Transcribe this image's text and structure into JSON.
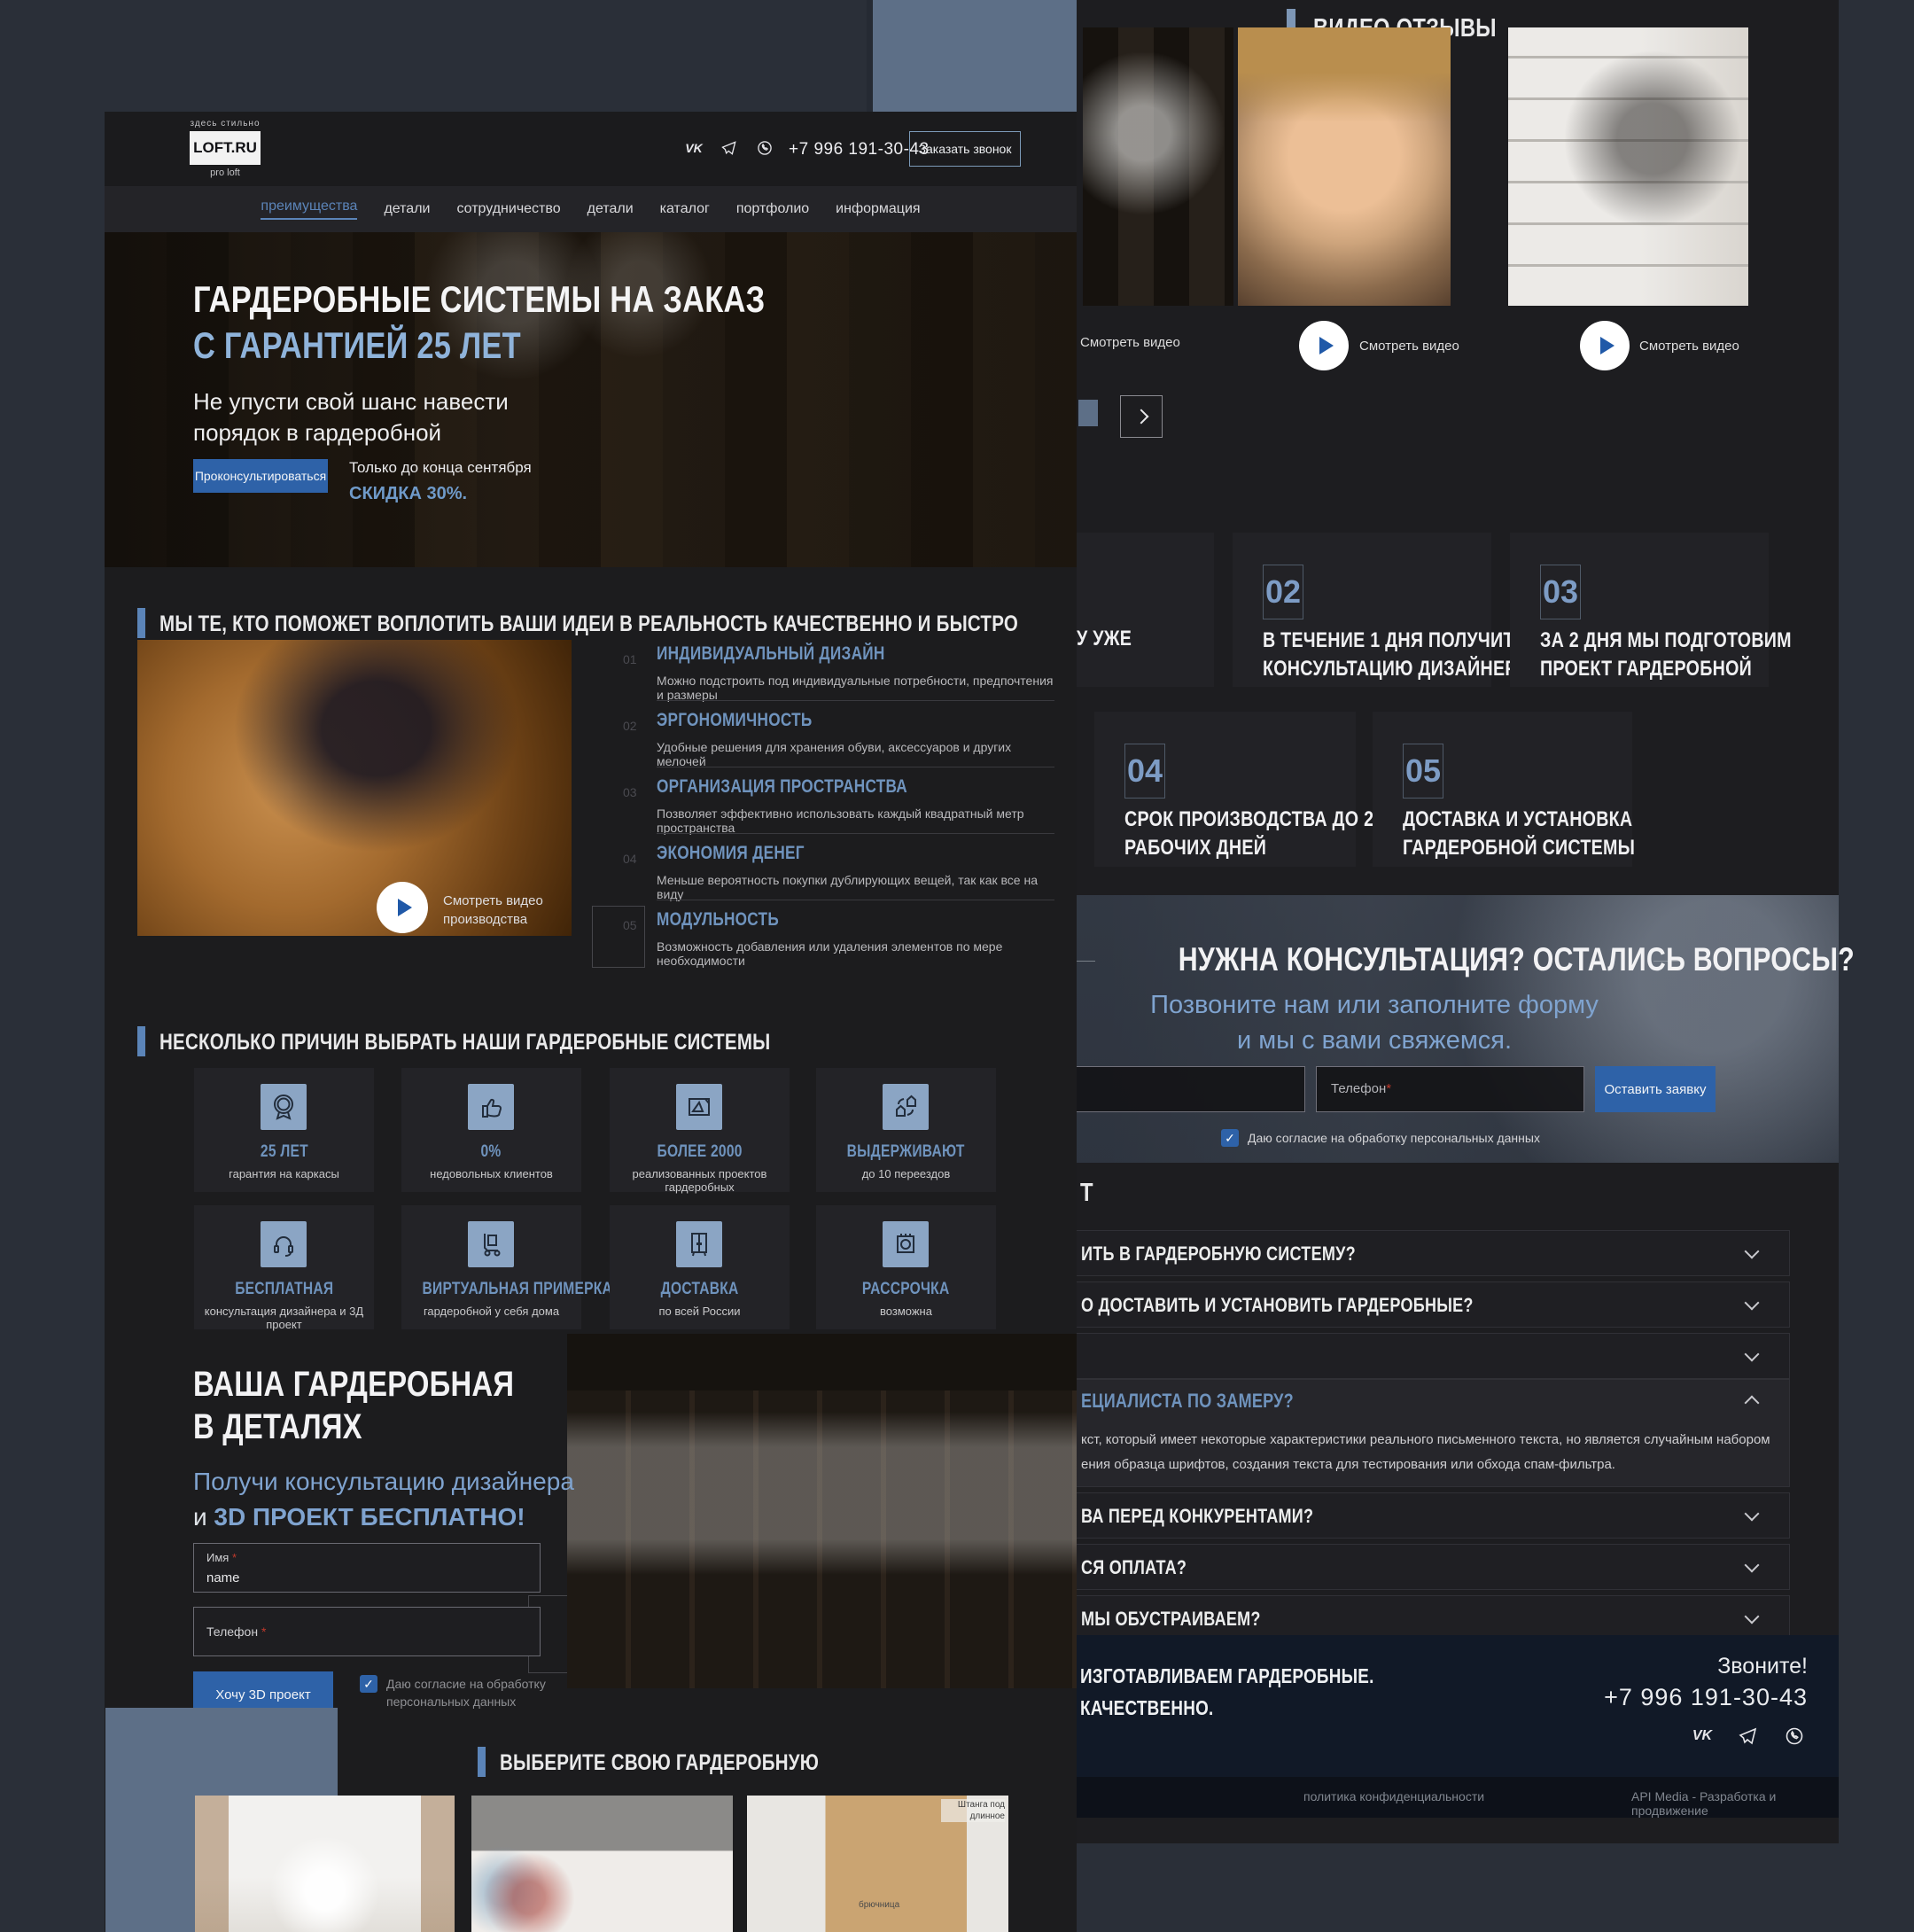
{
  "theme": {
    "canvas_bg": "#2a2f38",
    "page_bg": "#1c1c1e",
    "accent_button_blue": "#2e62a8",
    "heading_blue": "#6f93bd",
    "light_blue": "#8fb3da",
    "slate_decor": "#5d6f87",
    "footer_bg": "#111927"
  },
  "left_page": {
    "header": {
      "logo_top": "здесь стильно",
      "logo": "LOFT.RU",
      "logo_bottom": "pro loft",
      "socials": [
        "vk",
        "telegram",
        "whatsapp"
      ],
      "phone": "+7 996 191-30-43",
      "call_button": "Заказать звонок"
    },
    "nav": {
      "items": [
        {
          "label": "преимущества",
          "active": true
        },
        {
          "label": "детали"
        },
        {
          "label": "сотрудничество"
        },
        {
          "label": "детали"
        },
        {
          "label": "каталог"
        },
        {
          "label": "портфолио"
        },
        {
          "label": "информация"
        }
      ]
    },
    "hero": {
      "title_line1": "ГАРДЕРОБНЫЕ СИСТЕМЫ НА ЗАКАЗ",
      "title_line2": "С ГАРАНТИЕЙ 25 ЛЕТ",
      "subtitle_line1": "Не упусти свой шанс навести",
      "subtitle_line2": "порядок в гардеробной",
      "cta": "Проконсультироваться",
      "promo_line1": "Только до конца сентября",
      "promo_line2": "СКИДКА 30%."
    },
    "ideas": {
      "title": "МЫ ТЕ, КТО ПОМОЖЕТ ВОПЛОТИТЬ ВАШИ ИДЕИ В РЕАЛЬНОСТЬ КАЧЕСТВЕННО И БЫСТРО",
      "video_label": "Смотреть видео производства",
      "items": [
        {
          "num": "01",
          "title": "ИНДИВИДУАЛЬНЫЙ ДИЗАЙН",
          "text": "Можно подстроить под индивидуальные потребности, предпочтения и размеры"
        },
        {
          "num": "02",
          "title": "ЭРГОНОМИЧНОСТЬ",
          "text": "Удобные решения для хранения обуви, аксессуаров и других мелочей"
        },
        {
          "num": "03",
          "title": "ОРГАНИЗАЦИЯ ПРОСТРАНСТВА",
          "text": "Позволяет эффективно использовать каждый квадратный метр пространства"
        },
        {
          "num": "04",
          "title": "ЭКОНОМИЯ ДЕНЕГ",
          "text": "Меньше вероятность покупки дублирующих вещей, так как все на виду"
        },
        {
          "num": "05",
          "title": "МОДУЛЬНОСТЬ",
          "text": "Возможность добавления или удаления элементов по мере необходимости"
        }
      ]
    },
    "reasons": {
      "title": "НЕСКОЛЬКО ПРИЧИН ВЫБРАТЬ НАШИ ГАРДЕРОБНЫЕ СИСТЕМЫ",
      "cards": [
        {
          "icon": "guarantee-badge-icon",
          "title": "25 ЛЕТ",
          "text": "гарантия на каркасы"
        },
        {
          "icon": "thumb-up-icon",
          "title": "0%",
          "text": "недовольных клиентов"
        },
        {
          "icon": "blueprint-icon",
          "title": "БОЛЕЕ 2000",
          "text": "реализованных проектов гардеробных"
        },
        {
          "icon": "relocation-icon",
          "title": "ВЫДЕРЖИВАЮТ",
          "text": "до 10 переездов"
        },
        {
          "icon": "headset-icon",
          "title": "БЕСПЛАТНАЯ",
          "text": "консультация дизайнера и 3Д проект"
        },
        {
          "icon": "hand-truck-icon",
          "title": "ВИРТУАЛЬНАЯ ПРИМЕРКА",
          "text": "гардеробной у себя дома"
        },
        {
          "icon": "wardrobe-icon",
          "title": "ДОСТАВКА",
          "text": "по всей России"
        },
        {
          "icon": "installment-icon",
          "title": "РАССРОЧКА",
          "text": "возможна"
        }
      ]
    },
    "details": {
      "title_line1": "ВАША ГАРДЕРОБНАЯ",
      "title_line2": "В ДЕТАЛЯХ",
      "subtitle_line1": "Получи консультацию дизайнера",
      "subtitle_prefix": "и ",
      "subtitle_bold": "3D ПРОЕКТ БЕСПЛАТНО!",
      "form": {
        "name_label": "Имя",
        "name_value": "name",
        "phone_label": "Телефон",
        "required_mark": "*",
        "submit": "Хочу 3D проект",
        "consent_line1": "Даю  согласие на обработку",
        "consent_line2": "персональных данных"
      }
    },
    "choose": {
      "title": "ВЫБЕРИТЕ СВОЮ ГАРДЕРОБНУЮ",
      "annotation_1": "Штанга под длинное",
      "annotation_2": "брючница"
    }
  },
  "right_page": {
    "video_reviews": {
      "title": "ВИДЕО ОТЗЫВЫ",
      "watch_label": "Смотреть видео"
    },
    "steps": {
      "items": [
        {
          "number": "",
          "label_line1": "У УЖЕ",
          "label_line2": ""
        },
        {
          "number": "02",
          "label_line1": "В ТЕЧЕНИЕ 1 ДНЯ ПОЛУЧИТЕ",
          "label_line2": "КОНСУЛЬТАЦИЮ ДИЗАЙНЕРА"
        },
        {
          "number": "03",
          "label_line1": "ЗА 2 ДНЯ МЫ ПОДГОТОВИМ",
          "label_line2": "ПРОЕКТ ГАРДЕРОБНОЙ"
        },
        {
          "number": "04",
          "label_line1": "СРОК ПРОИЗВОДСТВА ДО 20",
          "label_line2": "РАБОЧИХ ДНЕЙ"
        },
        {
          "number": "05",
          "label_line1": "ДОСТАВКА И УСТАНОВКА",
          "label_line2": "ГАРДЕРОБНОЙ СИСТЕМЫ"
        }
      ]
    },
    "consult": {
      "title": "НУЖНА КОНСУЛЬТАЦИЯ? ОСТАЛИСЬ ВОПРОСЫ?",
      "subtitle_line1": "Позвоните нам или заполните форму",
      "subtitle_line2": "и мы с вами свяжемся.",
      "phone_placeholder": "Телефон",
      "required_mark": "*",
      "submit": "Оставить заявку",
      "consent": "Даю  согласие на обработку персональных данных"
    },
    "faq": {
      "title_fragment": "Т",
      "items": [
        {
          "question": "ИТЬ В ГАРДЕРОБНУЮ СИСТЕМУ?"
        },
        {
          "question": "О ДОСТАВИТЬ И УСТАНОВИТЬ ГАРДЕРОБНЫЕ?"
        },
        {
          "question": ""
        },
        {
          "question": "ЕЦИАЛИСТА ПО ЗАМЕРУ?",
          "answer_line1": "кст, который имеет некоторые характеристики реального письменного текста, но является случайным набором слов или сгенерирован иным образом. Его можно",
          "answer_line2": "ения образца шрифтов, создания текста для тестирования или обхода спам-фильтра."
        },
        {
          "question": "ВА ПЕРЕД КОНКУРЕНТАМИ?"
        },
        {
          "question": "СЯ ОПЛАТА?"
        },
        {
          "question": "МЫ ОБУСТРАИВАЕМ?"
        }
      ]
    },
    "footer": {
      "left_line1": "ИЗГОТАВЛИВАЕМ ГАРДЕРОБНЫЕ.",
      "left_line2": "КАЧЕСТВЕННО.",
      "call": "Звоните!",
      "phone": "+7 996 191-30-43",
      "socials": [
        "vk",
        "telegram",
        "whatsapp"
      ],
      "privacy": "политика конфиденциальности",
      "credit": "API Media - Разработка и продвижение"
    }
  }
}
